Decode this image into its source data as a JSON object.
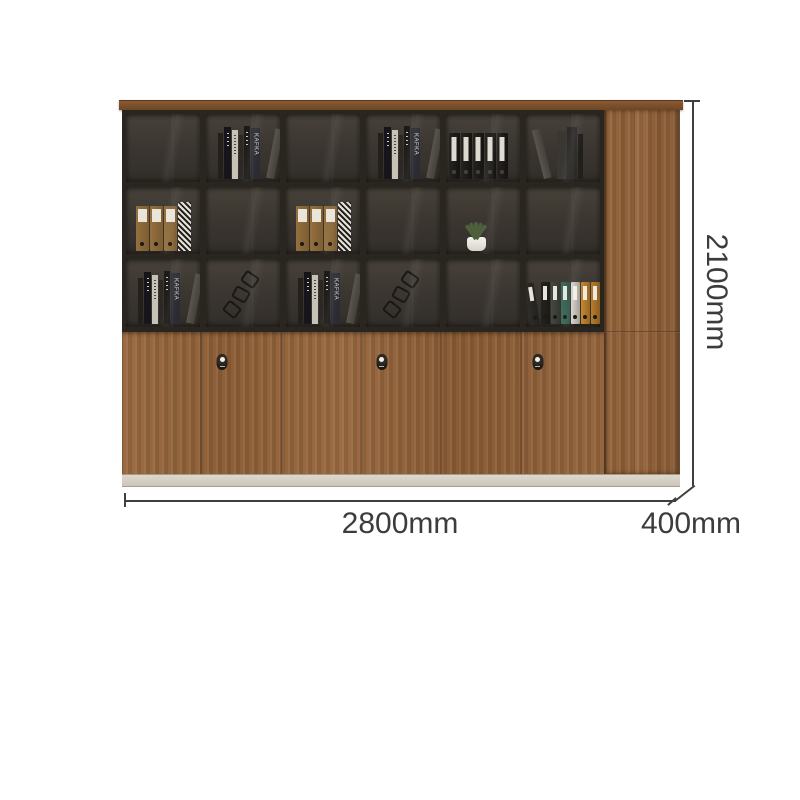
{
  "product": {
    "type": "office wooden file bookcase cabinet with glass display shelves",
    "dimensions": {
      "height": "2100mm",
      "width": "2800mm",
      "depth": "400mm"
    }
  },
  "dimensions": {
    "height": "2100mm",
    "width": "2800mm",
    "depth": "400mm"
  },
  "colors": {
    "background": "#ffffff",
    "wood": "#97683e",
    "wood_dark": "#8a5c36",
    "top_cap": "#7c5130",
    "frame": "#29251f",
    "cell_interior": "#3a3530",
    "base_plinth": "#d7d1c6",
    "dimension_line": "#3f3f3f",
    "label_text": "#3c3c3c",
    "brown_binder": "#8f683c",
    "black_binder": "#1d1c1a",
    "plant_green": "#4d603b",
    "pot_white": "#f0eee9",
    "colorful_binders": [
      "#2e2c29",
      "#24221d",
      "#454a40",
      "#3f6f5f",
      "#d9d5cb",
      "#c8892f",
      "#b97d2c"
    ]
  },
  "cabinet": {
    "shelf_grid": {
      "rows": 3,
      "columns": 6
    },
    "shelf_cells": [
      {
        "row": 1,
        "col": 1,
        "item": "empty"
      },
      {
        "row": 1,
        "col": 2,
        "item": "book-stack"
      },
      {
        "row": 1,
        "col": 3,
        "item": "empty"
      },
      {
        "row": 1,
        "col": 4,
        "item": "book-stack"
      },
      {
        "row": 1,
        "col": 5,
        "item": "black-binders"
      },
      {
        "row": 1,
        "col": 6,
        "item": "leaning-books"
      },
      {
        "row": 2,
        "col": 1,
        "item": "brown-binders"
      },
      {
        "row": 2,
        "col": 2,
        "item": "empty"
      },
      {
        "row": 2,
        "col": 3,
        "item": "brown-binders"
      },
      {
        "row": 2,
        "col": 4,
        "item": "empty"
      },
      {
        "row": 2,
        "col": 5,
        "item": "plant"
      },
      {
        "row": 2,
        "col": 6,
        "item": "empty"
      },
      {
        "row": 3,
        "col": 1,
        "item": "book-stack"
      },
      {
        "row": 3,
        "col": 2,
        "item": "wire-decor"
      },
      {
        "row": 3,
        "col": 3,
        "item": "book-stack"
      },
      {
        "row": 3,
        "col": 4,
        "item": "wire-decor"
      },
      {
        "row": 3,
        "col": 5,
        "item": "empty"
      },
      {
        "row": 3,
        "col": 6,
        "item": "colorful-binders"
      }
    ],
    "book_spine_text": "KAFKA",
    "lower_doors": {
      "door_count": 6,
      "lock_count": 3,
      "seam_fractions": [
        0.166,
        0.332,
        0.498,
        0.664,
        0.83
      ],
      "lock_fractions": [
        0.2075,
        0.539,
        0.863
      ]
    }
  }
}
